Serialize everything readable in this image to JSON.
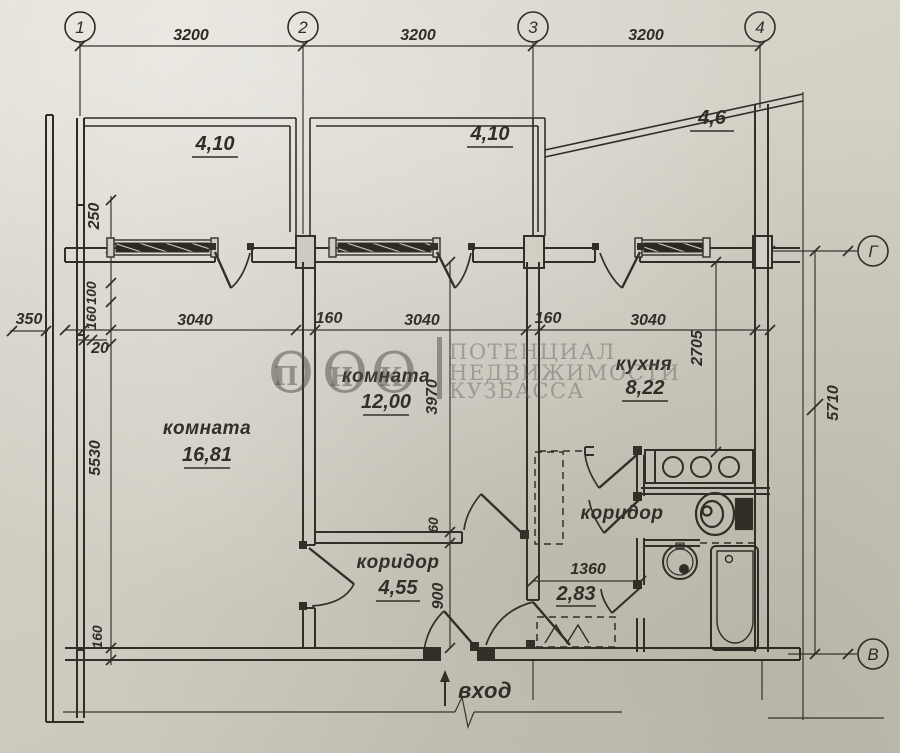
{
  "axes": {
    "v1": "1",
    "v2": "2",
    "v3": "3",
    "v4": "4",
    "h_top": "Г",
    "h_bottom": "В"
  },
  "top_dims": [
    "3200",
    "3200",
    "3200"
  ],
  "row_dims": {
    "w1": "3040",
    "g1": "160",
    "w2": "3040",
    "g2": "160",
    "w3": "3040"
  },
  "left_dims": {
    "balcony": "250",
    "off100": "100",
    "off160": "160",
    "wall350": "350",
    "off20": "20",
    "room": "5530",
    "bottom": "160"
  },
  "mid_dims": {
    "room2_depth": "3970",
    "small": "60",
    "entry": "900",
    "hall": "1360"
  },
  "right_dims": {
    "kitchen_depth": "2705",
    "total": "5710"
  },
  "rooms": {
    "room1": {
      "name": "комната",
      "area": "16,81"
    },
    "room2": {
      "name": "комната",
      "area": "12,00"
    },
    "kitchen": {
      "name": "кухня",
      "area": "8,22"
    },
    "hall1": {
      "name": "коридор",
      "area": "4,55"
    },
    "hall2": {
      "name": "коридор",
      "area": "2,83"
    }
  },
  "balconies": {
    "b1": "4,10",
    "b2": "4,10",
    "b3": "4,6"
  },
  "entrance_label": "вход",
  "watermark": {
    "o": "О",
    "p": "П",
    "n": "Н",
    "k": "К",
    "line1": "ПОТЕНЦИАЛ",
    "line2": "НЕДВИЖИМОСТИ",
    "line3": "КУЗБАССА"
  },
  "colors": {
    "ink": "#2d2a24",
    "paper": "#d8d4ca",
    "window_fill": "#26231e"
  }
}
